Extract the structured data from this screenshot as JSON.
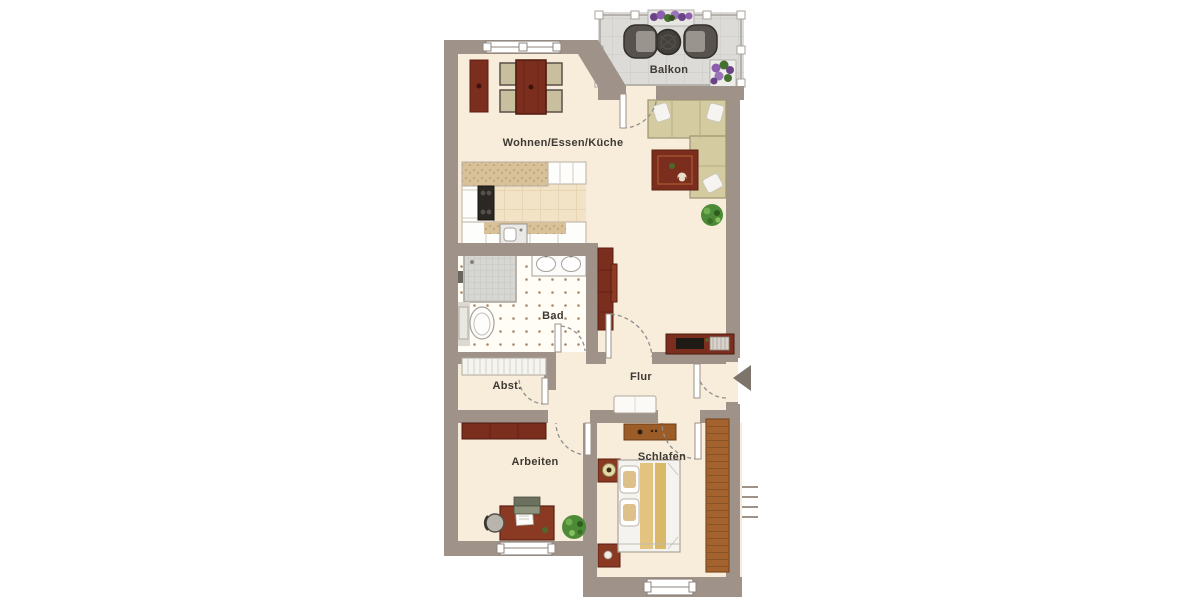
{
  "plan": {
    "type": "apartment-floorplan",
    "rooms": {
      "balkon": {
        "label": "Balkon"
      },
      "wohnen": {
        "label": "Wohnen/Essen/Küche"
      },
      "bad": {
        "label": "Bad"
      },
      "abst": {
        "label": "Abst."
      },
      "flur": {
        "label": "Flur"
      },
      "arbeiten": {
        "label": "Arbeiten"
      },
      "schlafen": {
        "label": "Schlafen"
      }
    },
    "markers": {
      "entrance": "left-pointing arrow at apartment entry door",
      "stairs": "four tick marks outside right wall"
    },
    "colors": {
      "wall": "#9e9289",
      "room_floor": "#f8edda",
      "balcony_floor": "#dcdbd8",
      "kitchen_tile": "#f2e2c6",
      "countertop_speckle": "#d8c199",
      "dark_wood_furniture": "#7c2e1e",
      "mid_wood_furniture": "#a3622e",
      "sofa": "#d5cba0",
      "bed_blanket": "#e2c47f",
      "plant_green": "#4c8a38",
      "flower_purple": "#8b5fae",
      "door_arc": "#8f8f8f",
      "label_text": "#3e3933"
    }
  }
}
